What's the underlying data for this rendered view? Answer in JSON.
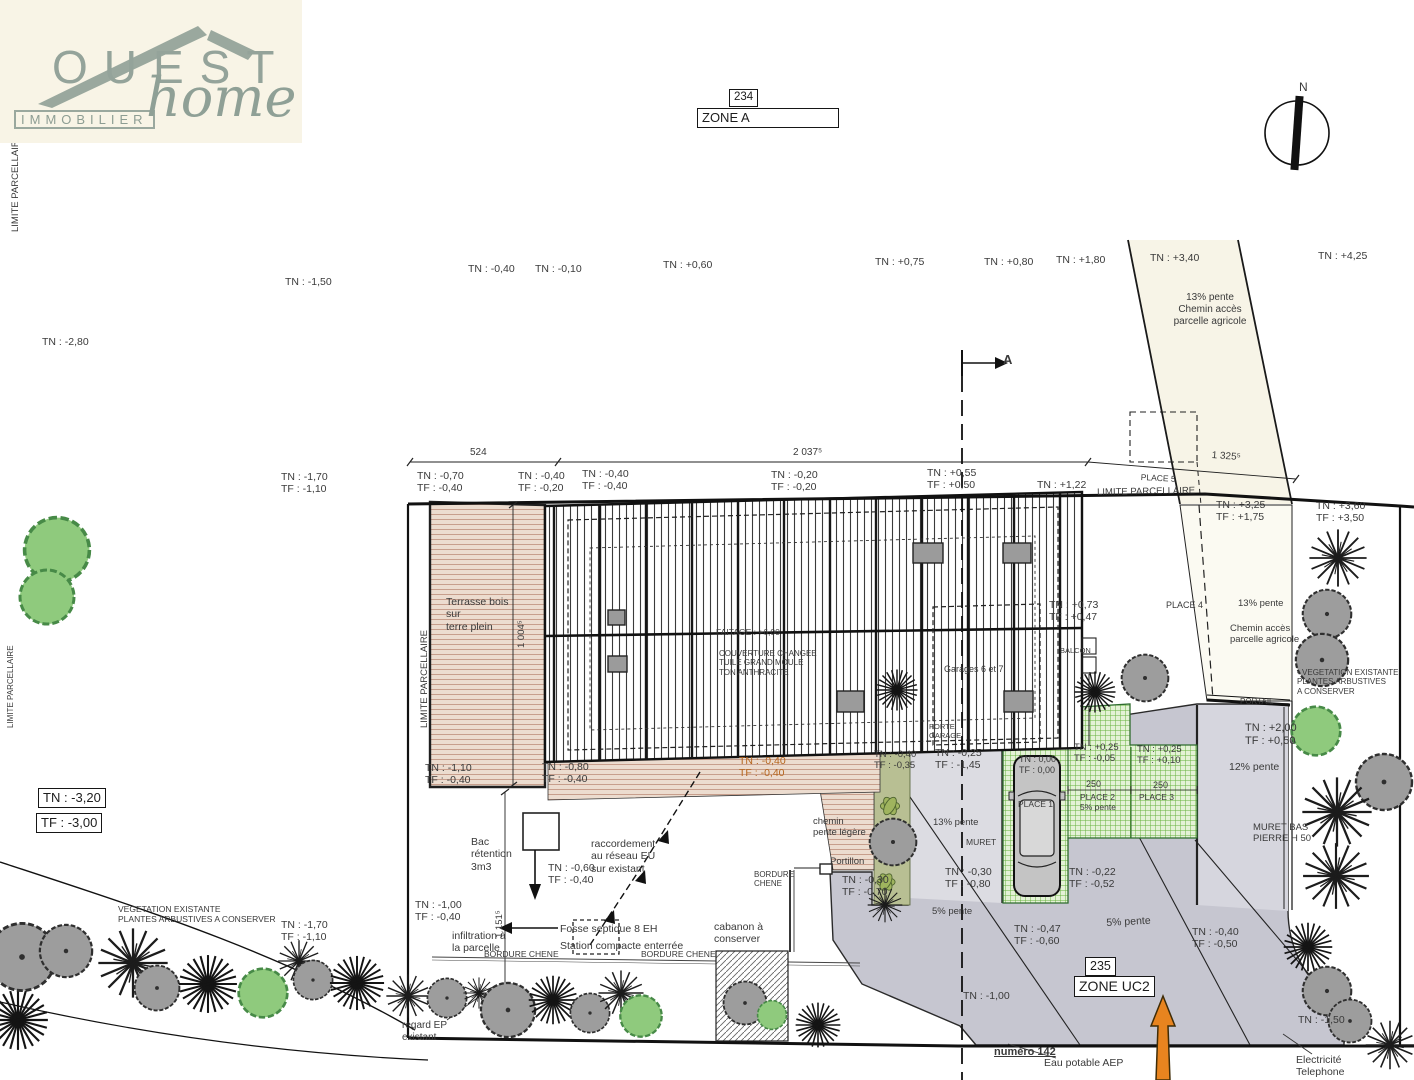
{
  "logo": {
    "name": "OUEST",
    "tagline": "IMMOBILIER",
    "script": "home"
  },
  "colors": {
    "terrace_tan": "#ecdccf",
    "terrace_line": "#c79e8c",
    "driveway_gray": "#c6c6d0",
    "driveway_light": "#dcdce2",
    "paver_green_line": "#66b23d",
    "paver_green_bg": "#e4f2d6",
    "path_cream": "#f7f4e7",
    "olive_strip": "#b8bf93",
    "tree_green": "#8fca7d",
    "tree_gray": "#9d9d9d",
    "logo_green": "#94a39a",
    "orange_arrow": "#e8841f",
    "tn_orange": "#b5651d",
    "line_black": "#1a1a1a"
  },
  "labels": [
    {
      "t": "TN : -2,80",
      "x": 42,
      "y": 336
    },
    {
      "t": "TN : -1,50",
      "x": 285,
      "y": 276
    },
    {
      "t": "TN : -0,40",
      "x": 468,
      "y": 263
    },
    {
      "t": "TN : -0,10",
      "x": 535,
      "y": 263
    },
    {
      "t": "TN : +0,60",
      "x": 663,
      "y": 259
    },
    {
      "t": "TN : +0,75",
      "x": 875,
      "y": 256
    },
    {
      "t": "TN : +0,80",
      "x": 984,
      "y": 256
    },
    {
      "t": "TN : +1,80",
      "x": 1056,
      "y": 254
    },
    {
      "t": "TN : +3,40",
      "x": 1150,
      "y": 252
    },
    {
      "t": "TN : +4,25",
      "x": 1318,
      "y": 250
    },
    {
      "t": "13% pente\nChemin accès\nparcelle agricole",
      "x": 1155,
      "y": 292,
      "al": "center",
      "w": 110,
      "fs": 10
    },
    {
      "t": "524",
      "x": 470,
      "y": 447,
      "fs": 10
    },
    {
      "t": "2 037⁵",
      "x": 793,
      "y": 447,
      "fs": 10
    },
    {
      "t": "1 325⁵",
      "x": 1212,
      "y": 450,
      "fs": 10,
      "rot": 4
    },
    {
      "t": "PLACE 5",
      "x": 1141,
      "y": 472,
      "fs": 8.5,
      "rot": 3
    },
    {
      "t": "LIMITE PARCELLAIRE",
      "x": 1097,
      "y": 487,
      "fs": 9.5,
      "rot": -1
    },
    {
      "t": "TN : -1,70\nTF : -1,10",
      "x": 281,
      "y": 471
    },
    {
      "t": "TN : -0,70\nTF : -0,40",
      "x": 417,
      "y": 470
    },
    {
      "t": "TN : -0,40\nTF : -0,20",
      "x": 518,
      "y": 470
    },
    {
      "t": "TN : -0,40\nTF : -0,40",
      "x": 582,
      "y": 468
    },
    {
      "t": "TN : -0,20\nTF : -0,20",
      "x": 771,
      "y": 469
    },
    {
      "t": "TN : +0,55\nTF : +0,50",
      "x": 927,
      "y": 467
    },
    {
      "t": "TN : +1,22",
      "x": 1037,
      "y": 479
    },
    {
      "t": "TN : +3,25\nTF : +1,75",
      "x": 1216,
      "y": 499
    },
    {
      "t": "TN : +3,60\nTF : +3,50",
      "x": 1316,
      "y": 500
    },
    {
      "t": "13% pente",
      "x": 1238,
      "y": 598,
      "fs": 9.5
    },
    {
      "t": "Chemin accès\nparcelle agricole",
      "x": 1230,
      "y": 623,
      "fs": 9.5
    },
    {
      "t": "PLACE 4",
      "x": 1166,
      "y": 600,
      "fs": 9
    },
    {
      "t": "TN : +0,73\nTF : +0,47",
      "x": 1049,
      "y": 599
    },
    {
      "t": "BALCON",
      "x": 1060,
      "y": 647,
      "fs": 7.5
    },
    {
      "t": "Terrasse bois\nsur\nterre plein",
      "x": 446,
      "y": 596
    },
    {
      "t": "FAITAGE : +6,00",
      "x": 716,
      "y": 627,
      "fs": 8.5
    },
    {
      "t": "COUVERTURE CHANGEE\nTUILE GRAND MOULE\nTON ANTHRACITE",
      "x": 719,
      "y": 649,
      "fs": 8
    },
    {
      "t": "Garages 6 et 7",
      "x": 944,
      "y": 664,
      "fs": 9
    },
    {
      "t": "• VEGETATION EXISTANTE\nPLANTES ARBUSTIVES\nA CONSERVER",
      "x": 1297,
      "y": 668,
      "fs": 8
    },
    {
      "t": "PORTAIL",
      "x": 1240,
      "y": 697,
      "fs": 8
    },
    {
      "t": "TN : +2,00\nTF : +0,50",
      "x": 1245,
      "y": 722,
      "fs": 11
    },
    {
      "t": "12% pente",
      "x": 1229,
      "y": 761
    },
    {
      "t": "PORTE\nGARAGE",
      "x": 929,
      "y": 723,
      "fs": 7.5
    },
    {
      "t": "TN : -0,25\nTF : -1,45",
      "x": 935,
      "y": 747
    },
    {
      "t": "TN : -0,40\nTF : -0,35",
      "x": 874,
      "y": 749,
      "fs": 9.5
    },
    {
      "t": "TN : 0,00\nTF : 0,00",
      "x": 1019,
      "y": 754,
      "fs": 9
    },
    {
      "t": "TN : +0,25\nTF : -0,05",
      "x": 1074,
      "y": 742,
      "fs": 9.5
    },
    {
      "t": "TN : +0,25\nTF : +0,10",
      "x": 1137,
      "y": 744,
      "fs": 9.5
    },
    {
      "t": "TN : -0,40\nTF : -0,40",
      "x": 739,
      "y": 755,
      "c": "#b5651d"
    },
    {
      "t": "TN : -1,10\nTF : -0,40",
      "x": 425,
      "y": 762
    },
    {
      "t": "TN : -0,80\nTF : -0,40",
      "x": 542,
      "y": 761
    },
    {
      "t": "250",
      "x": 1086,
      "y": 779,
      "fs": 9
    },
    {
      "t": "250",
      "x": 1153,
      "y": 780,
      "fs": 9
    },
    {
      "t": "PLACE 2\n5% pente",
      "x": 1080,
      "y": 792,
      "fs": 8.5
    },
    {
      "t": "PLACE 3",
      "x": 1139,
      "y": 792,
      "fs": 8.5
    },
    {
      "t": "PLACE 1",
      "x": 1018,
      "y": 799,
      "fs": 8.5
    },
    {
      "t": "MURET BAS\nPIERRE H 50",
      "x": 1253,
      "y": 822,
      "fs": 9.5
    },
    {
      "t": "chemin\npente légère",
      "x": 813,
      "y": 816,
      "fs": 9.5
    },
    {
      "t": "13% pente",
      "x": 933,
      "y": 817,
      "fs": 9.5
    },
    {
      "t": "MURET",
      "x": 966,
      "y": 837,
      "fs": 8.5
    },
    {
      "t": "Portillon",
      "x": 830,
      "y": 856,
      "fs": 9.5
    },
    {
      "t": "BORDURE\nCHENE",
      "x": 754,
      "y": 870,
      "fs": 8
    },
    {
      "t": "TN : -0,30\nTF : -0,70",
      "x": 842,
      "y": 874
    },
    {
      "t": "TN : -0,30\nTF : -0,80",
      "x": 945,
      "y": 866
    },
    {
      "t": "TN : -0,22\nTF : -0,52",
      "x": 1069,
      "y": 866
    },
    {
      "t": "Bac\nrétention\n3m3",
      "x": 471,
      "y": 836
    },
    {
      "t": "TN : -0,60\nTF : -0,40",
      "x": 548,
      "y": 862
    },
    {
      "t": "raccordement\nau réseau EU\nsur existant",
      "x": 591,
      "y": 838
    },
    {
      "t": "5% pente",
      "x": 932,
      "y": 906,
      "fs": 9.5
    },
    {
      "t": "VEGETATION EXISTANTE\nPLANTES ARBUSTIVES A CONSERVER",
      "x": 118,
      "y": 904,
      "fs": 8.5
    },
    {
      "t": "TN : -1,70\nTF : -1,10",
      "x": 281,
      "y": 919
    },
    {
      "t": "TN : -1,00\nTF : -0,40",
      "x": 415,
      "y": 899
    },
    {
      "t": "5% pente",
      "x": 1106,
      "y": 917,
      "rot": -3
    },
    {
      "t": "TN : -0,47\nTF : -0,60",
      "x": 1014,
      "y": 923
    },
    {
      "t": "TN : -0,40\nTF : -0,50",
      "x": 1192,
      "y": 926
    },
    {
      "t": "infiltration à\nla parcelle",
      "x": 452,
      "y": 930
    },
    {
      "t": "Fosse septique 8 EH",
      "x": 560,
      "y": 923
    },
    {
      "t": "Station compacte enterrée",
      "x": 560,
      "y": 940
    },
    {
      "t": "cabanon à\nconserver",
      "x": 714,
      "y": 921
    },
    {
      "t": "BORDURE CHENE",
      "x": 484,
      "y": 949,
      "fs": 8.5
    },
    {
      "t": "BORDURE CHENE",
      "x": 641,
      "y": 949,
      "fs": 8.5
    },
    {
      "t": "TN : -1,00",
      "x": 963,
      "y": 990
    },
    {
      "t": "TN : -1,50",
      "x": 1298,
      "y": 1014
    },
    {
      "t": "regard EP\nexistant",
      "x": 402,
      "y": 1020,
      "fs": 10
    },
    {
      "t": "numéro 142",
      "x": 994,
      "y": 1046,
      "fs": 11,
      "b": true,
      "u": true,
      "n": "street-number-label"
    },
    {
      "t": "Eau potable AEP",
      "x": 1044,
      "y": 1057,
      "n": "water-network-label"
    },
    {
      "t": "Electricité\nTelephone",
      "x": 1296,
      "y": 1054,
      "n": "utilities-label"
    },
    {
      "t": "N",
      "x": 1299,
      "y": 80,
      "fs": 12,
      "n": "north-label"
    },
    {
      "t": "A",
      "x": 1003,
      "y": 352,
      "fs": 13,
      "b": true,
      "n": "section-a-label"
    },
    {
      "t": "LIMITE PARCELLAIRE",
      "x": 10,
      "y": 232,
      "fs": 9.5,
      "rot": -90
    },
    {
      "t": "LIMITE PARCELLAIRE",
      "x": 419,
      "y": 728,
      "fs": 9.5,
      "rot": -90
    },
    {
      "t": "LIMITE PARCELLAIRE",
      "x": 6,
      "y": 728,
      "fs": 8,
      "rot": -90
    },
    {
      "t": "1 004⁵",
      "x": 516,
      "y": 648,
      "fs": 9.5,
      "rot": -90
    },
    {
      "t": "1 151⁵",
      "x": 494,
      "y": 938,
      "fs": 9.5,
      "rot": -90
    },
    {
      "t": "TN : -3,20",
      "x": 38,
      "y": 788,
      "fs": 13,
      "box": true,
      "n": "tn-benchmark-box"
    },
    {
      "t": "TF : -3,00",
      "x": 36,
      "y": 813,
      "fs": 13,
      "box": true,
      "n": "tf-benchmark-box"
    },
    {
      "t": "234",
      "x": 729,
      "y": 89,
      "fs": 11.5,
      "box": true,
      "n": "parcel-234-label"
    },
    {
      "t": "ZONE A",
      "x": 697,
      "y": 108,
      "fs": 13,
      "box": true,
      "w": 132,
      "n": "zone-a-label"
    },
    {
      "t": "235",
      "x": 1085,
      "y": 957,
      "fs": 12.5,
      "box": true,
      "n": "parcel-235-label"
    },
    {
      "t": "ZONE UC2",
      "x": 1074,
      "y": 976,
      "fs": 14,
      "box": true,
      "n": "zone-uc2-label"
    }
  ],
  "trees": [
    {
      "t": "gr",
      "x": 57,
      "y": 550,
      "r": 36
    },
    {
      "t": "gr",
      "x": 47,
      "y": 597,
      "r": 30
    },
    {
      "t": "br",
      "x": 1338,
      "y": 558,
      "r": 33
    },
    {
      "t": "g",
      "x": 1327,
      "y": 614,
      "r": 26
    },
    {
      "t": "g",
      "x": 1322,
      "y": 660,
      "r": 28
    },
    {
      "t": "gr",
      "x": 1316,
      "y": 731,
      "r": 27
    },
    {
      "t": "g",
      "x": 1384,
      "y": 782,
      "r": 30
    },
    {
      "t": "br",
      "x": 1337,
      "y": 812,
      "r": 40
    },
    {
      "t": "br",
      "x": 1336,
      "y": 876,
      "r": 38
    },
    {
      "t": "b",
      "x": 1308,
      "y": 947,
      "r": 26
    },
    {
      "t": "g",
      "x": 1327,
      "y": 991,
      "r": 26
    },
    {
      "t": "g",
      "x": 1350,
      "y": 1021,
      "r": 23
    },
    {
      "t": "br",
      "x": 1390,
      "y": 1045,
      "r": 28
    },
    {
      "t": "b",
      "x": 18,
      "y": 1020,
      "r": 32
    },
    {
      "t": "g",
      "x": 22,
      "y": 957,
      "r": 36
    },
    {
      "t": "g",
      "x": 66,
      "y": 951,
      "r": 28
    },
    {
      "t": "br",
      "x": 133,
      "y": 963,
      "r": 40
    },
    {
      "t": "g",
      "x": 157,
      "y": 988,
      "r": 24
    },
    {
      "t": "b",
      "x": 208,
      "y": 984,
      "r": 31
    },
    {
      "t": "gr",
      "x": 263,
      "y": 993,
      "r": 27
    },
    {
      "t": "br",
      "x": 299,
      "y": 961,
      "r": 24
    },
    {
      "t": "g",
      "x": 313,
      "y": 980,
      "r": 21
    },
    {
      "t": "b",
      "x": 357,
      "y": 983,
      "r": 29
    },
    {
      "t": "br",
      "x": 408,
      "y": 996,
      "r": 25
    },
    {
      "t": "g",
      "x": 447,
      "y": 998,
      "r": 21
    },
    {
      "t": "br",
      "x": 479,
      "y": 993,
      "r": 18
    },
    {
      "t": "g",
      "x": 508,
      "y": 1010,
      "r": 29
    },
    {
      "t": "b",
      "x": 553,
      "y": 1000,
      "r": 26
    },
    {
      "t": "g",
      "x": 590,
      "y": 1013,
      "r": 21
    },
    {
      "t": "br",
      "x": 621,
      "y": 993,
      "r": 26
    },
    {
      "t": "gr",
      "x": 641,
      "y": 1016,
      "r": 23
    },
    {
      "t": "g",
      "x": 745,
      "y": 1003,
      "r": 23
    },
    {
      "t": "gr",
      "x": 772,
      "y": 1015,
      "r": 16
    },
    {
      "t": "b",
      "x": 818,
      "y": 1025,
      "r": 24
    },
    {
      "t": "b",
      "x": 897,
      "y": 690,
      "r": 22
    },
    {
      "t": "b",
      "x": 1095,
      "y": 692,
      "r": 22
    },
    {
      "t": "g",
      "x": 1145,
      "y": 678,
      "r": 25
    },
    {
      "t": "g",
      "x": 893,
      "y": 842,
      "r": 25
    },
    {
      "t": "lf",
      "x": 890,
      "y": 806,
      "r": 18
    },
    {
      "t": "lf",
      "x": 886,
      "y": 882,
      "r": 17
    },
    {
      "t": "br",
      "x": 885,
      "y": 905,
      "r": 20
    }
  ]
}
